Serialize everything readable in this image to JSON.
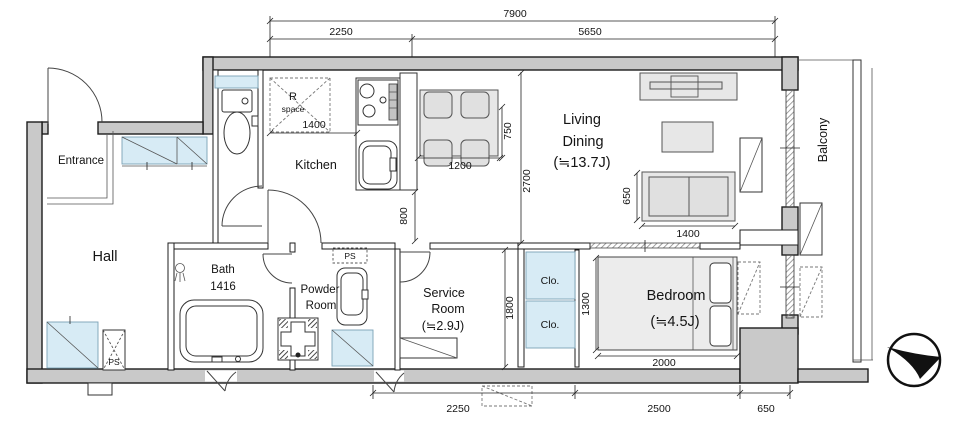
{
  "rooms": {
    "entrance": "Entrance",
    "hall": "Hall",
    "kitchen": "Kitchen",
    "living1": "Living",
    "living2": "Dining",
    "living_size": "(≒13.7J)",
    "bedroom": "Bedroom",
    "bedroom_size": "(≒4.5J)",
    "service1": "Service",
    "service2": "Room",
    "service_size": "(≒2.9J)",
    "bath1": "Bath",
    "bath2": "1416",
    "powder1": "Powder",
    "powder2": "Room",
    "balcony": "Balcony",
    "rspace1": "R",
    "rspace2": "space",
    "clo1": "Clo.",
    "clo2": "Clo.",
    "ps_top": "PS",
    "ps_left": "PS"
  },
  "dims": {
    "top_total": "7900",
    "top_left": "2250",
    "top_right": "5650",
    "kitchen_w": "1400",
    "table_w": "1200",
    "table_d": "750",
    "ld_h": "2700",
    "pass": "800",
    "sofa_d": "650",
    "sofa_w": "1400",
    "service_h": "1800",
    "bed_d": "1300",
    "bed_w": "2000",
    "bottom_left": "2250",
    "bottom_mid": "2500",
    "bottom_right": "650"
  },
  "colors": {
    "wall_fill": "#c9c9c9",
    "fixture_blue": "#d7ebf5",
    "furniture_gray": "#e7e7e7",
    "line": "#1c1c1c"
  }
}
